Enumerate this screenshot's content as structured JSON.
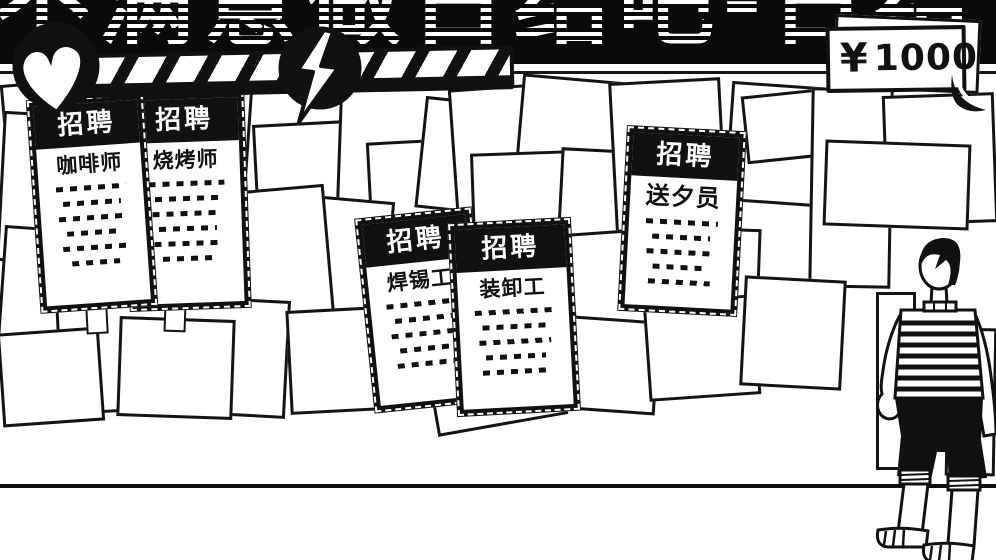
{
  "scene": {
    "title_marquee": "不满意做日结吧-日结"
  },
  "hud": {
    "currency_symbol": "¥",
    "money_amount": "1000"
  },
  "board": {
    "flyers": [
      {
        "header": "招聘",
        "job": "咖啡师"
      },
      {
        "header": "招聘",
        "job": "烧烤师"
      },
      {
        "header": "招聘",
        "job": "焊锡工"
      },
      {
        "header": "招聘",
        "job": "装卸工"
      },
      {
        "header": "招聘",
        "job": "送夕员"
      }
    ]
  },
  "icons": [
    {
      "name": "heart-icon"
    },
    {
      "name": "lightning-icon"
    }
  ],
  "colors": {
    "ink": "#111111",
    "paper": "#ffffff",
    "banner": "#0a0a0a"
  }
}
